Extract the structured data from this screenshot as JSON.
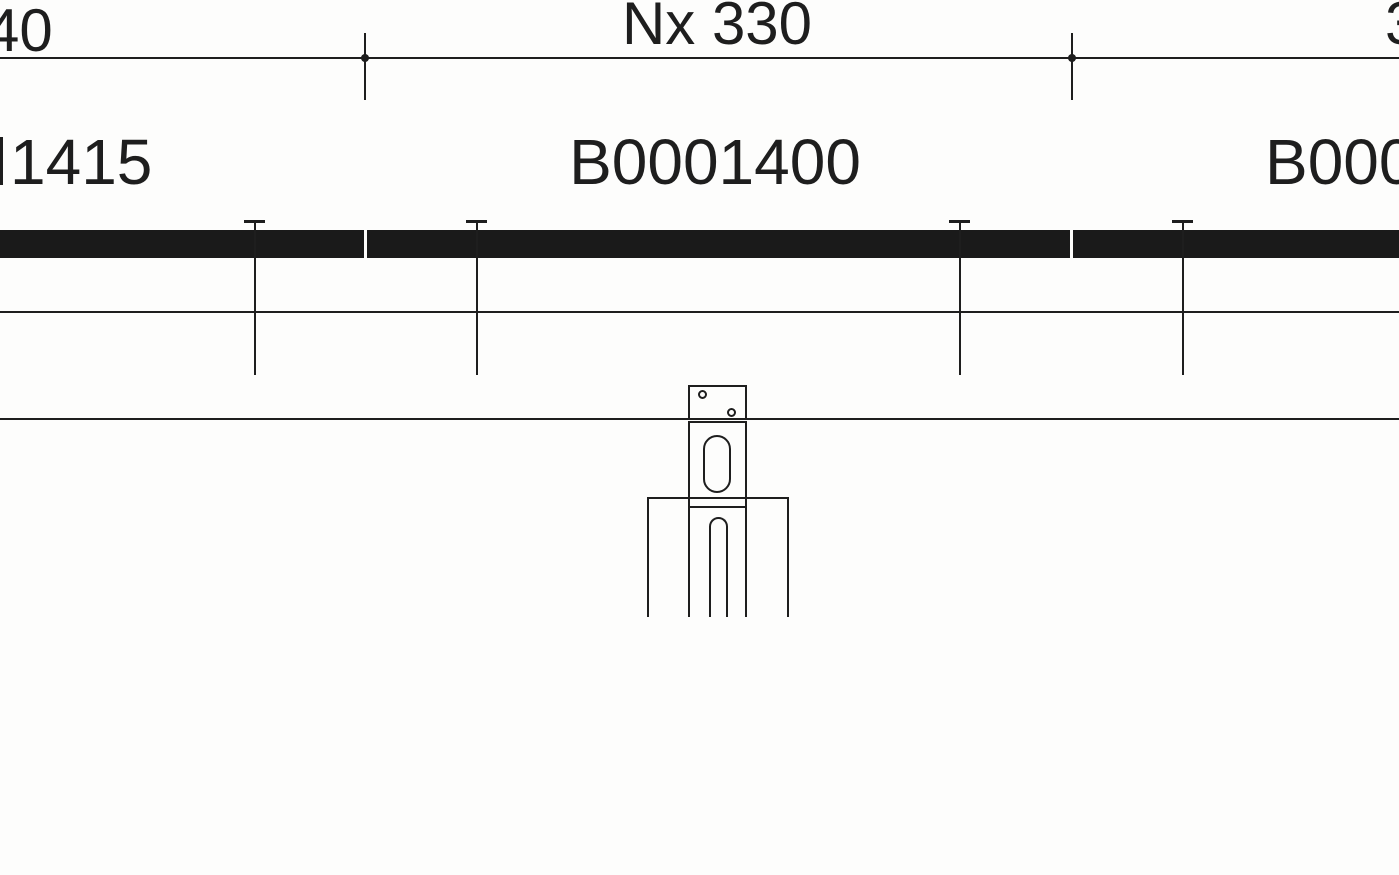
{
  "colors": {
    "ink": "#1e1e1e",
    "rail_fill": "#1a1a1a",
    "background": "#fdfdfc"
  },
  "dimension_row": {
    "left_value": "40",
    "span_value": "Nx 330",
    "right_value": "3"
  },
  "part_labels": {
    "left": "1415",
    "center": "B0001400",
    "right": "B000"
  }
}
